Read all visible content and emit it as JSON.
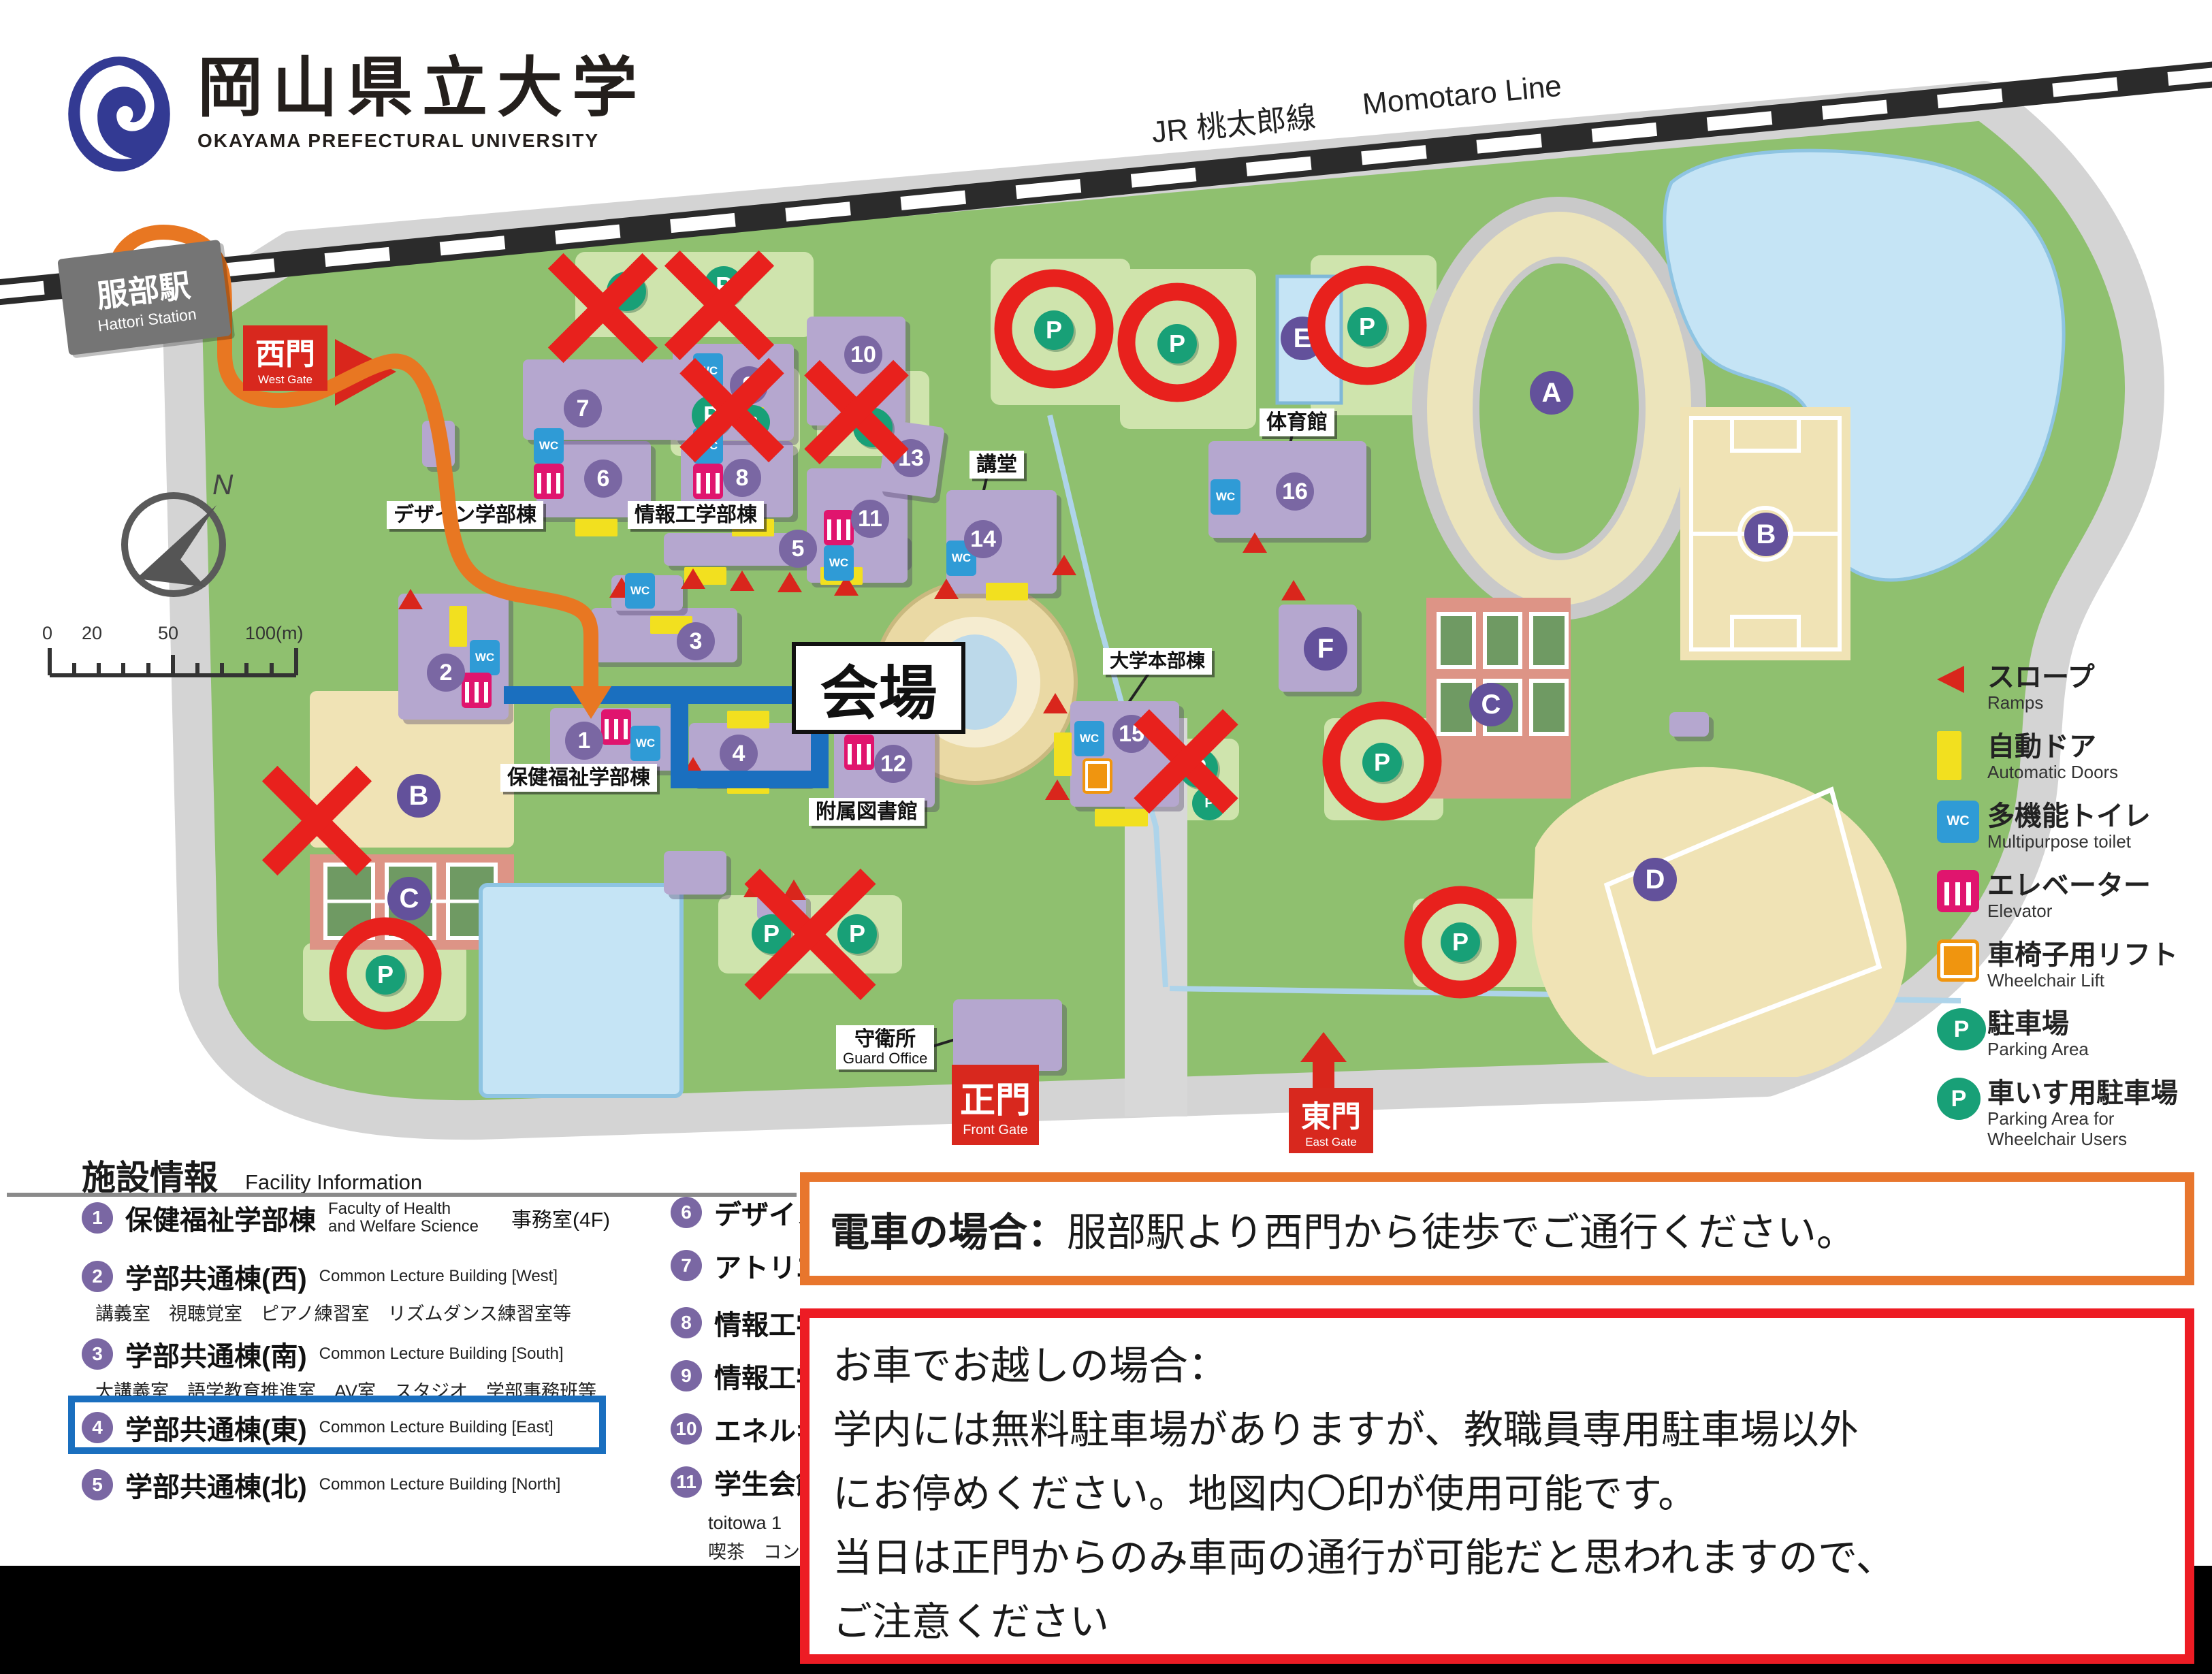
{
  "logo": {
    "ja": "岡山県立大学",
    "en": "OKAYAMA PREFECTURAL UNIVERSITY"
  },
  "railway": {
    "jr": "JR 桃太郎線",
    "en": "Momotaro Line"
  },
  "station": {
    "ja": "服部駅",
    "en": "Hattori Station"
  },
  "gates": {
    "west": {
      "ja": "西門",
      "en": "West Gate"
    },
    "front": {
      "ja": "正門",
      "en": "Front Gate"
    },
    "east": {
      "ja": "東門",
      "en": "East Gate"
    }
  },
  "venue": {
    "label": "会場"
  },
  "compass": {
    "n": "N"
  },
  "scalebar": {
    "t0": "0",
    "t1": "20",
    "t2": "50",
    "t3": "100(m)"
  },
  "map_labels": {
    "design": "デザイン学部棟",
    "info_eng": "情報工学部棟",
    "health": "保健福祉学部棟",
    "library": "附属図書館",
    "admin": "大学本部棟",
    "auditorium": "講堂",
    "gym": "体育館",
    "guard_ja": "守衛所",
    "guard_en": "Guard Office"
  },
  "map": {
    "numbers": [
      "1",
      "2",
      "3",
      "4",
      "5",
      "6",
      "7",
      "8",
      "9",
      "10",
      "11",
      "12",
      "13",
      "14",
      "15",
      "16"
    ],
    "letters": [
      "A",
      "B",
      "C",
      "D",
      "E",
      "F"
    ],
    "p": "P",
    "wc": "WC"
  },
  "legend": {
    "items": [
      {
        "icon": "ramp-icon",
        "ja": "スロープ",
        "en": "Ramps"
      },
      {
        "icon": "automatic-door-icon",
        "ja": "自動ドア",
        "en": "Automatic Doors"
      },
      {
        "icon": "multipurpose-toilet-icon",
        "ja": "多機能トイレ",
        "en": "Multipurpose toilet"
      },
      {
        "icon": "elevator-icon",
        "ja": "エレベーター",
        "en": "Elevator"
      },
      {
        "icon": "wheelchair-lift-icon",
        "ja": "車椅子用リフト",
        "en": "Wheelchair Lift"
      },
      {
        "icon": "parking-icon",
        "ja": "駐車場",
        "en": "Parking Area"
      },
      {
        "icon": "wheelchair-parking-icon",
        "ja": "車いす用駐車場",
        "en": "Parking Area for",
        "en2": "Wheelchair Users"
      }
    ]
  },
  "facility": {
    "title_ja": "施設情報",
    "title_en": "Facility Information",
    "col1": [
      {
        "num": "1",
        "ja": "保健福祉学部棟",
        "en": "Faculty of Health",
        "en2": "and Welfare Science",
        "extra": "事務室(4F)"
      },
      {
        "num": "2",
        "ja": "学部共通棟(西)",
        "en": "Common Lecture Building [West]",
        "sub": "講義室　視聴覚室　ピアノ練習室　リズムダンス練習室等"
      },
      {
        "num": "3",
        "ja": "学部共通棟(南)",
        "en": "Common Lecture Building [South]",
        "sub": "大講義室　語学教育推進室　AV室　スタジオ　学部事務班等"
      },
      {
        "num": "4",
        "ja": "学部共通棟(東)",
        "en": "Common Lecture Building [East]"
      },
      {
        "num": "5",
        "ja": "学部共通棟(北)",
        "en": "Common Lecture Building [North]"
      }
    ],
    "col2": [
      {
        "num": "6",
        "ja": "デザイン"
      },
      {
        "num": "7",
        "ja": "アトリエ"
      },
      {
        "num": "8",
        "ja": "情報工学"
      },
      {
        "num": "9",
        "ja": "情報工学"
      },
      {
        "num": "10",
        "ja": "エネルギ"
      },
      {
        "num": "11",
        "ja": "学生会館",
        "sub1": "toitowa 1",
        "sub2": "喫茶　コン"
      }
    ]
  },
  "notices": {
    "train": {
      "head": "電車の場合：",
      "body": "服部駅より西門から徒歩でご通行ください。"
    },
    "car": {
      "lines": [
        "お車でお越しの場合：",
        "学内には無料駐車場がありますが、教職員専用駐車場以外",
        "にお停めください。地図内〇印が使用可能です。",
        "当日は正門からのみ車両の通行が可能だと思われますので、",
        "ご注意ください"
      ]
    }
  },
  "colors": {
    "accent_orange": "#e87722",
    "accent_red": "#e8211d",
    "highlight_blue": "#1a6fbf",
    "building_purple": "#b5a7cf",
    "parking_green": "#18a077"
  }
}
